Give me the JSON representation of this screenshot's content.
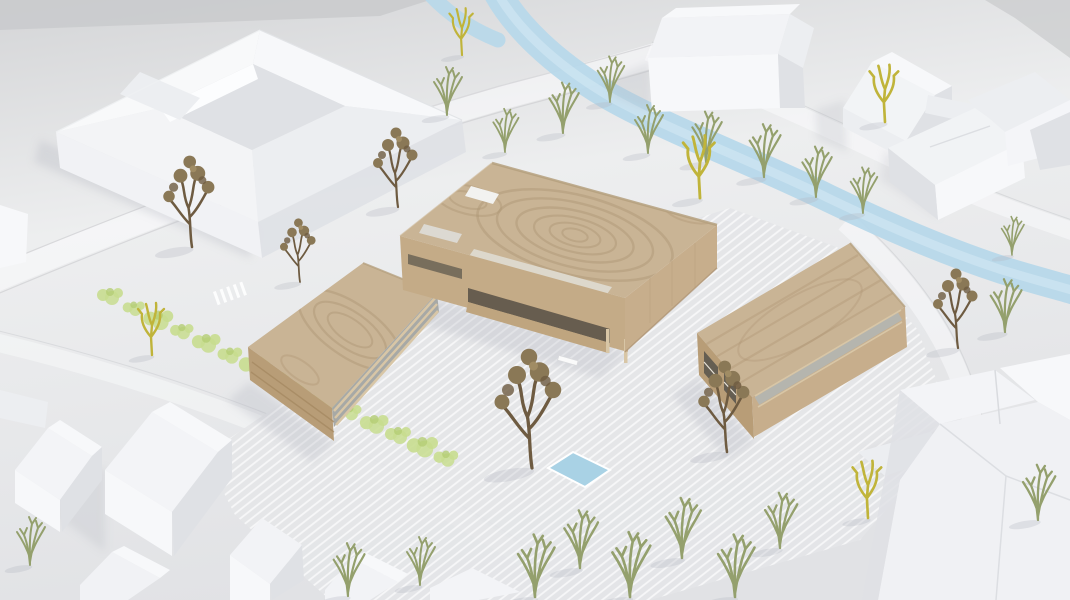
{
  "scene": {
    "description": "Aerial photograph of an architectural massing model: three light timber volumes on a striped plaza, surrounded by white model houses, a white courtyard block, bare model trees, engraved roads and a pale blue river",
    "ground": "matte white ground plane with engraved curving roads",
    "river": "pale blue stream crossing the upper part toward the right edge",
    "pool": "small rectangular blue pool on the plaza",
    "hedge": "row of light green shrubs along the south-west road",
    "buildings": {
      "timber_main": "large flat-roofed timber volume with swirling grain, roof cut-outs and a recessed glazed veranda",
      "timber_left": "small timber bar with horizontal louvred facade",
      "timber_right": "long timber bar with clerestory glazing band",
      "courtyard_block": "white perimeter block with inner courtyard",
      "context_houses": "white gabled houses (top right and bottom left) and flat-roofed white blocks (bottom right)"
    },
    "trees": {
      "brown_count": 6,
      "green_count": 21,
      "yellow_count": 5,
      "shrub_count": 15
    }
  },
  "colors": {
    "ground_top": "#d4d5d7",
    "ground_mid": "#edeeef",
    "ground_low": "#e1e2e5",
    "backdrop": "#c9cacc",
    "river": "#b7d8ea",
    "river_hi": "#d8ecf5",
    "pool": "#a9d2e5",
    "white_lit": "#f7f8fa",
    "white_mid": "#eceef1",
    "white_shade": "#dfe1e5",
    "wood_top": "#c9b495",
    "wood_grain": "#ab9271",
    "wood_light": "#d8c6a6",
    "wood_sw": "#b89d77",
    "wood_se": "#c7ae8c",
    "wood_dark": "#6b6355",
    "glass": "#a7a9a6",
    "terrace": "#ddd8cc",
    "tree_brown": "#8a7856",
    "tree_brown_dark": "#6e5b41",
    "tree_green": "#94a06d",
    "tree_yellow": "#c0b43a",
    "shrub": "#c8dd8f",
    "shadow": "#b4b6c0",
    "road_edge": "#c6c7cb",
    "paving_base": "#e4e5e8"
  }
}
